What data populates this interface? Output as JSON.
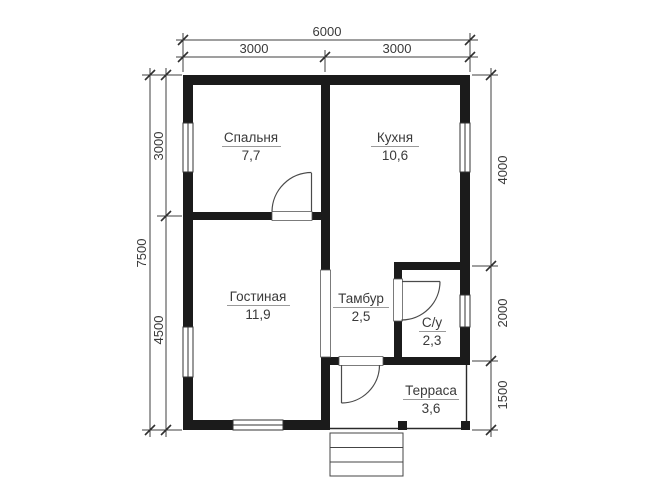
{
  "rooms": [
    {
      "name": "Спальня",
      "area": "7,7"
    },
    {
      "name": "Кухня",
      "area": "10,6"
    },
    {
      "name": "Гостиная",
      "area": "11,9"
    },
    {
      "name": "Тамбур",
      "area": "2,5"
    },
    {
      "name": "С/у",
      "area": "2,3"
    },
    {
      "name": "Терраса",
      "area": "3,6"
    }
  ],
  "dimensions": {
    "top": {
      "total": "6000",
      "left": "3000",
      "right": "3000"
    },
    "left": {
      "total": "7500",
      "upper": "3000",
      "lower": "4500"
    },
    "right": {
      "upper": "4000",
      "middle": "2000",
      "lower": "1500"
    }
  },
  "colors": {
    "wall": "#1b1b1b",
    "thin_line": "#3f3f3f",
    "text": "#3a3a3a",
    "background": "#ffffff"
  }
}
